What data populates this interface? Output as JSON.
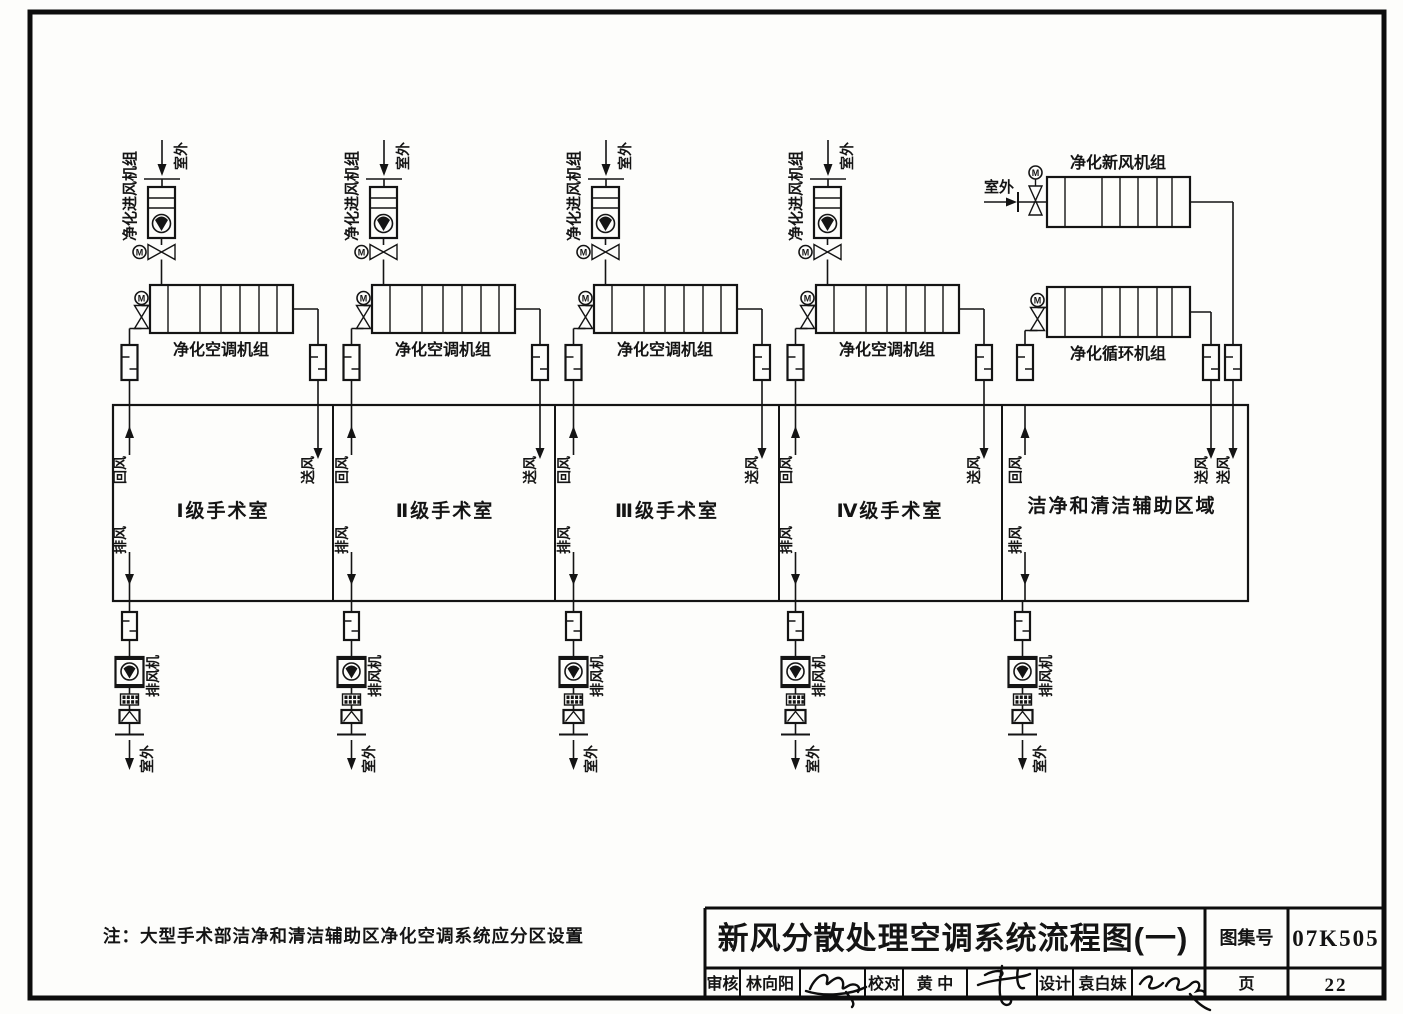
{
  "drawing": {
    "title": "新风分散处理空调系统流程图(一)",
    "note": "注：大型手术部洁净和清洁辅助区净化空调系统应分区设置"
  },
  "labels": {
    "outdoor": "室外",
    "intake_unit": "净化进风机组",
    "ahu_unit": "净化空调机组",
    "fresh_air_unit": "净化新风机组",
    "recirc_unit": "净化循环机组",
    "return_air": "回风",
    "supply_air": "送风",
    "exhaust_air": "排风",
    "exhaust_fan": "排风机",
    "motor": "M"
  },
  "rooms": [
    {
      "name": "Ⅰ级手术室"
    },
    {
      "name": "Ⅱ级手术室"
    },
    {
      "name": "Ⅲ级手术室"
    },
    {
      "name": "Ⅳ级手术室"
    },
    {
      "name": "洁净和清洁辅助区域"
    }
  ],
  "titleblock": {
    "atlas_label": "图集号",
    "atlas_no": "07K505",
    "page_label": "页",
    "page_no": "22",
    "reviewer_label": "审核",
    "reviewer": "林向阳",
    "checker_label": "校对",
    "checker": "黄 中",
    "designer_label": "设计",
    "designer": "袁白妹"
  }
}
